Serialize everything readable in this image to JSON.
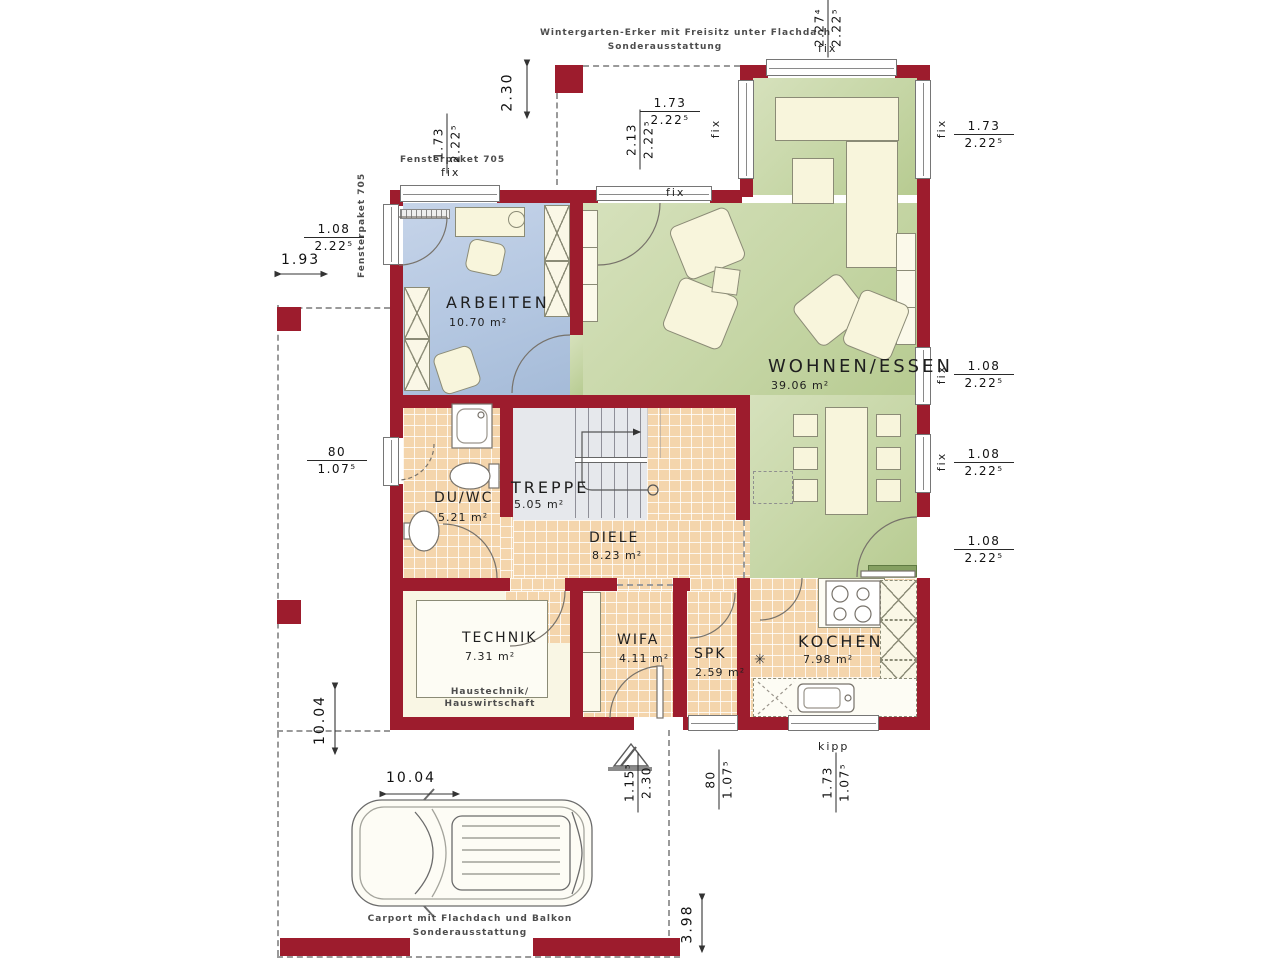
{
  "plan": {
    "rooms": {
      "arbeiten": {
        "name": "ARBEITEN",
        "area": "10.70 m²"
      },
      "wohnen": {
        "name": "WOHNEN/ESSEN",
        "area": "39.06 m²"
      },
      "duwc": {
        "name": "DU/WC",
        "area": "5.21 m²"
      },
      "treppe": {
        "name": "TREPPE",
        "area": "5.05 m²"
      },
      "diele": {
        "name": "DIELE",
        "area": "8.23 m²"
      },
      "technik": {
        "name": "TECHNIK",
        "area": "7.31 m²",
        "note_line1": "Haustechnik/",
        "note_line2": "Hauswirtschaft"
      },
      "wifa": {
        "name": "WIFA",
        "area": "4.11 m²"
      },
      "spk": {
        "name": "SPK",
        "area": "2.59 m²",
        "symbol": "✳"
      },
      "kochen": {
        "name": "KOCHEN",
        "area": "7.98 m²"
      }
    },
    "notes": {
      "wintergarten_line1": "Wintergarten-Erker mit Freisitz unter Flachdach",
      "wintergarten_line2": "Sonderausstattung",
      "carport_line1": "Carport mit Flachdach und Balkon",
      "carport_line2": "Sonderausstattung",
      "fensterpaket_top": "Fensterpaket 705",
      "fensterpaket_left": "Fensterpaket 705"
    },
    "window_labels": {
      "fix": "fix",
      "kipp": "kipp"
    },
    "dims": {
      "erker_top_width": {
        "a": "2.27⁴",
        "b": "2.22⁵"
      },
      "terrace_depth": "2.30",
      "terrace_width": {
        "a": "1.73",
        "b": "2.22⁵"
      },
      "terrace_height": {
        "a": "2.13",
        "b": "2.22⁵"
      },
      "erker_right": {
        "a": "1.73",
        "b": "2.22⁵"
      },
      "arbeiten_top": {
        "a": "1.73",
        "b": "2.22⁵"
      },
      "arbeiten_left": {
        "a": "1.08",
        "b": "2.22⁵"
      },
      "offset_left": "1.93",
      "duwc_window": {
        "a": "80",
        "b": "1.07⁵"
      },
      "right_window1": {
        "a": "1.08",
        "b": "2.22⁵"
      },
      "right_window2": {
        "a": "1.08",
        "b": "2.22⁵"
      },
      "right_door": {
        "a": "1.08",
        "b": "2.22⁵"
      },
      "house_depth": "10.04",
      "entry_door": {
        "a": "1.15⁵",
        "b": "2.30"
      },
      "spk_window": {
        "a": "80",
        "b": "1.07⁵"
      },
      "kitchen_window": {
        "a": "1.73",
        "b": "1.07⁵"
      },
      "carport_length": "10.04",
      "rear_offset": "3.98"
    },
    "colors": {
      "wall": "#9d1c2d",
      "room_blue": "#b4c7e1",
      "room_green": "#c6d6a6",
      "tile": "#f4d5ac",
      "stair_gray": "#e6e8ec",
      "cream": "#f9f6e4"
    }
  }
}
